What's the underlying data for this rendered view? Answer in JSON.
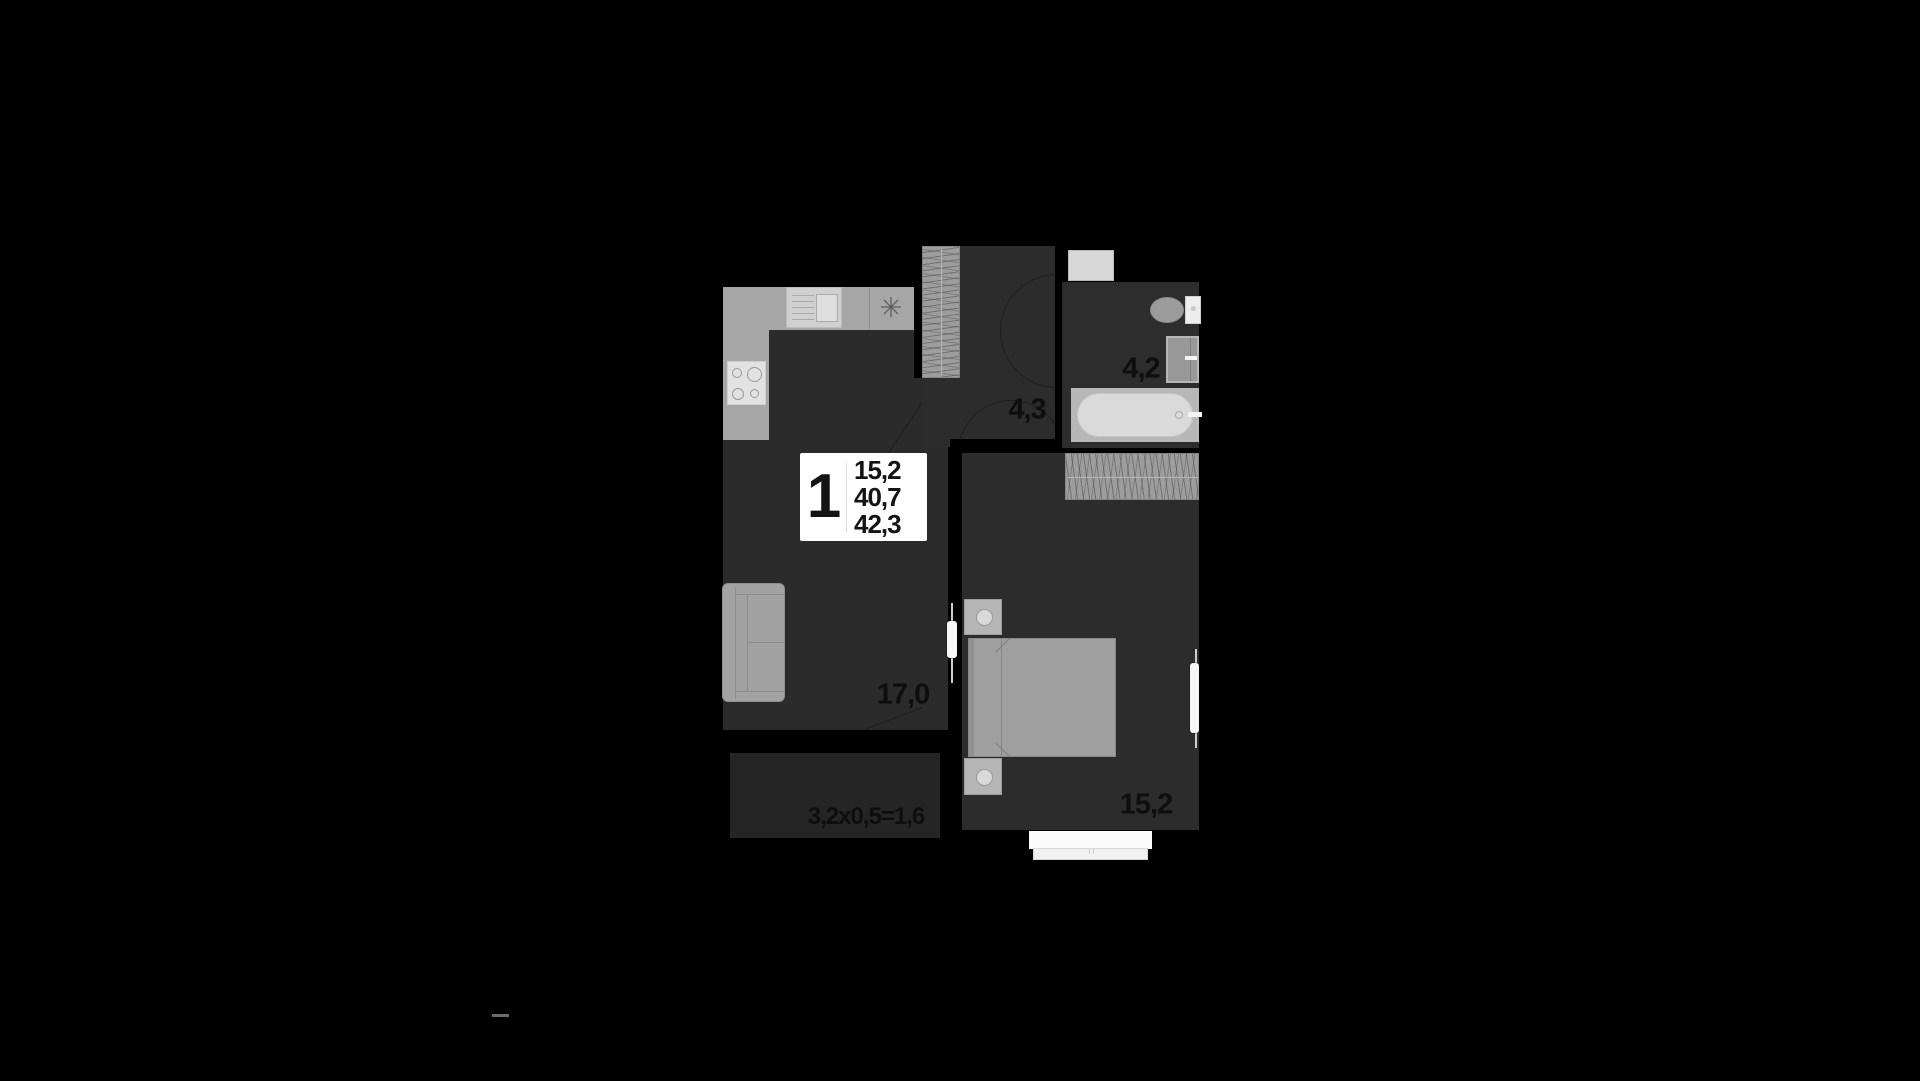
{
  "plan": {
    "unit_card": {
      "rooms": "1",
      "area_living": "15,2",
      "area_main": "40,7",
      "area_total": "42,3"
    },
    "rooms": {
      "living_kitchen": {
        "label": "17,0"
      },
      "hallway": {
        "label": "4,3"
      },
      "bathroom": {
        "label": "4,2"
      },
      "bedroom": {
        "label": "15,2"
      },
      "balcony": {
        "label": "3,2x0,5=1,6"
      }
    },
    "icons": {
      "kitchen_symbol": "eight-spoke-star"
    },
    "colors": {
      "background": "#000000",
      "floor": "#2b2b2b",
      "balcony_floor": "#252525",
      "furniture_gray": "#a4a4a4",
      "fixture_light": "#d9d9d9",
      "door_white": "#f6f6f6",
      "label_text": "#0e0e0e",
      "card_background": "#ffffff"
    }
  }
}
